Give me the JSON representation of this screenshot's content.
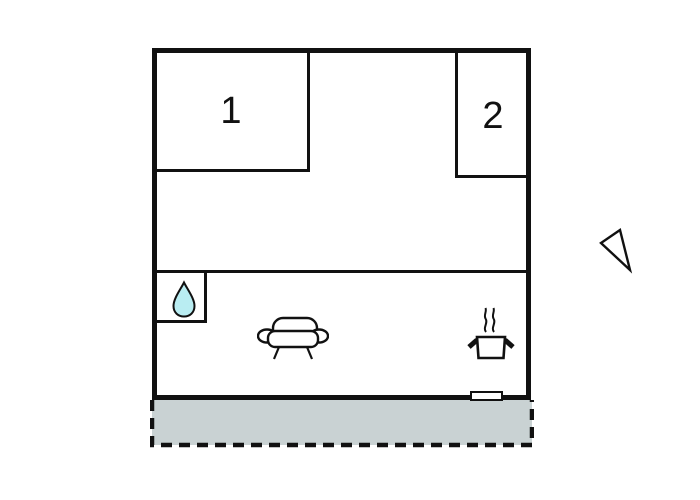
{
  "floorplan": {
    "rooms": [
      {
        "label": "1"
      },
      {
        "label": "2"
      }
    ],
    "features": {
      "bathroom_icon": "water-drop-icon",
      "living_room_icon": "sofa-icon",
      "kitchen_icon": "cooking-pot-icon",
      "entrance_marker": "door-marker",
      "outdoor_area": "terrace",
      "orientation_marker": "direction-arrow-icon"
    },
    "colors": {
      "wall": "#111111",
      "water_drop": "#b9edf2",
      "terrace": "#c9d2d3",
      "page_bg": "#ffffff"
    }
  }
}
